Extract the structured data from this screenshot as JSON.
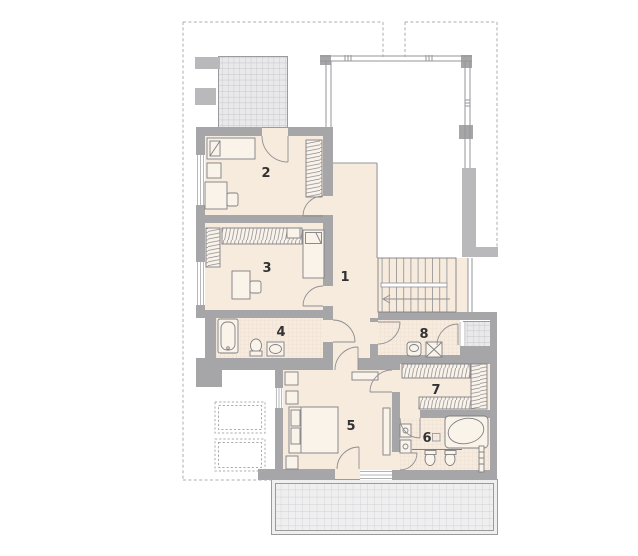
{
  "rooms": [
    {
      "label": "1"
    },
    {
      "label": "2"
    },
    {
      "label": "3"
    },
    {
      "label": "4"
    },
    {
      "label": "5"
    },
    {
      "label": "6"
    },
    {
      "label": "7"
    },
    {
      "label": "8"
    }
  ],
  "colors": {
    "wall": "#a6a6a8",
    "wall_light": "#b9b9bb",
    "floor": "#f7ebde",
    "terrace_tile": "#efeff0",
    "balcony_tile": "#e9e9ec",
    "tile_grid_line": "#c6c6ca",
    "bath_tile_line": "#e8d8cb",
    "dashed_outline": "#acacae",
    "furniture_line": "#7f7f83",
    "label_text": "#323234"
  }
}
